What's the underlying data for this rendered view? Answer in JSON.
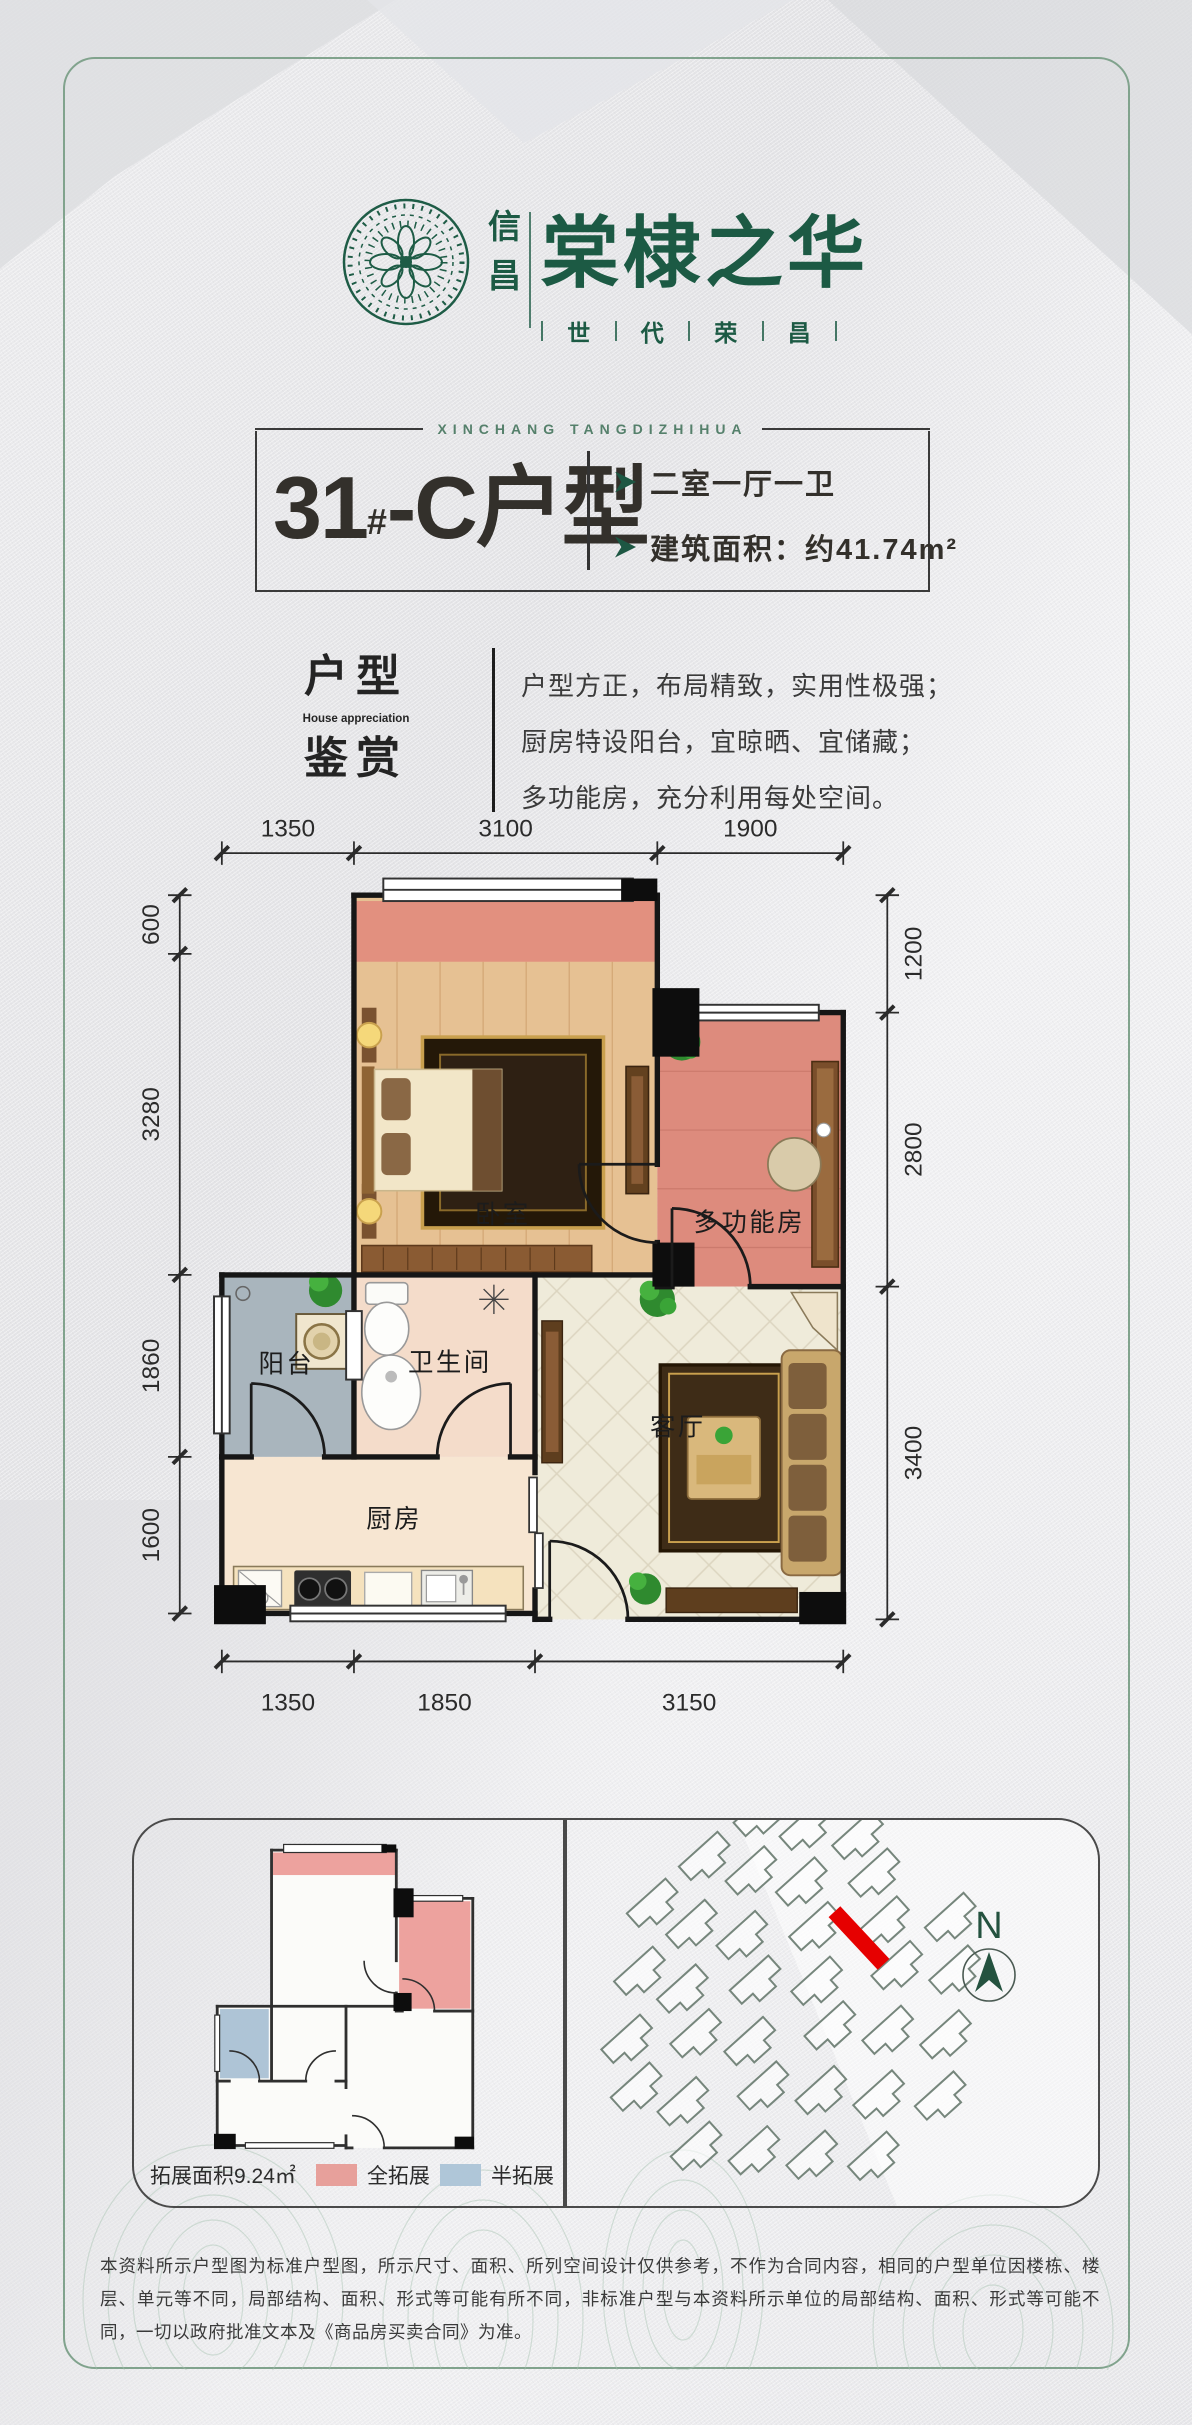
{
  "logo": {
    "seal_text_top": "信",
    "seal_text_bottom": "昌",
    "name": "棠棣之华",
    "slogan_chars": [
      "世",
      "代",
      "荣",
      "昌"
    ],
    "brand_green": "#1C5A44"
  },
  "header": {
    "en_subtitle": "XINCHANG TANGDIZHIHUA",
    "unit_number": "31",
    "unit_sup": "#",
    "unit_rest": "-C户型",
    "feature_1": "二室一厅一卫",
    "feature_2": "建筑面积：约41.74m²"
  },
  "appreciation": {
    "title_top": "户型",
    "title_en": "House appreciation",
    "title_bottom": "鉴赏",
    "line_1": "户型方正，布局精致，实用性极强；",
    "line_2": "厨房特设阳台，宜晾晒、宜储藏；",
    "line_3": "多功能房，充分利用每处空间。"
  },
  "floor_plan": {
    "rooms": {
      "bedroom": "卧室",
      "multi": "多功能房",
      "balcony": "阳台",
      "bath": "卫生间",
      "living": "客厅",
      "kitchen": "厨房"
    },
    "dims": {
      "top": [
        "1350",
        "3100",
        "1900"
      ],
      "bottom": [
        "1350",
        "1850",
        "3150"
      ],
      "left": [
        "600",
        "3280",
        "1860",
        "1600"
      ],
      "right": [
        "1200",
        "2800",
        "3400"
      ]
    }
  },
  "expansion": {
    "area_label": "拓展面积9.24㎡",
    "full_label": "全拓展",
    "full_color": "#E7A09B",
    "half_label": "半拓展",
    "half_color": "#AFC6D8"
  },
  "site": {
    "north_label": "N",
    "highlight_color": "#E60000"
  },
  "disclaimer": "本资料所示户型图为标准户型图，所示尺寸、面积、所列空间设计仅供参考，不作为合同内容，相同的户型单位因楼栋、楼层、单元等不同，局部结构、面积、形式等可能有所不同，非标准户型与本资料所示单位的局部结构、面积、形式等可能不同，一切以政府批准文本及《商品房买卖合同》为准。"
}
